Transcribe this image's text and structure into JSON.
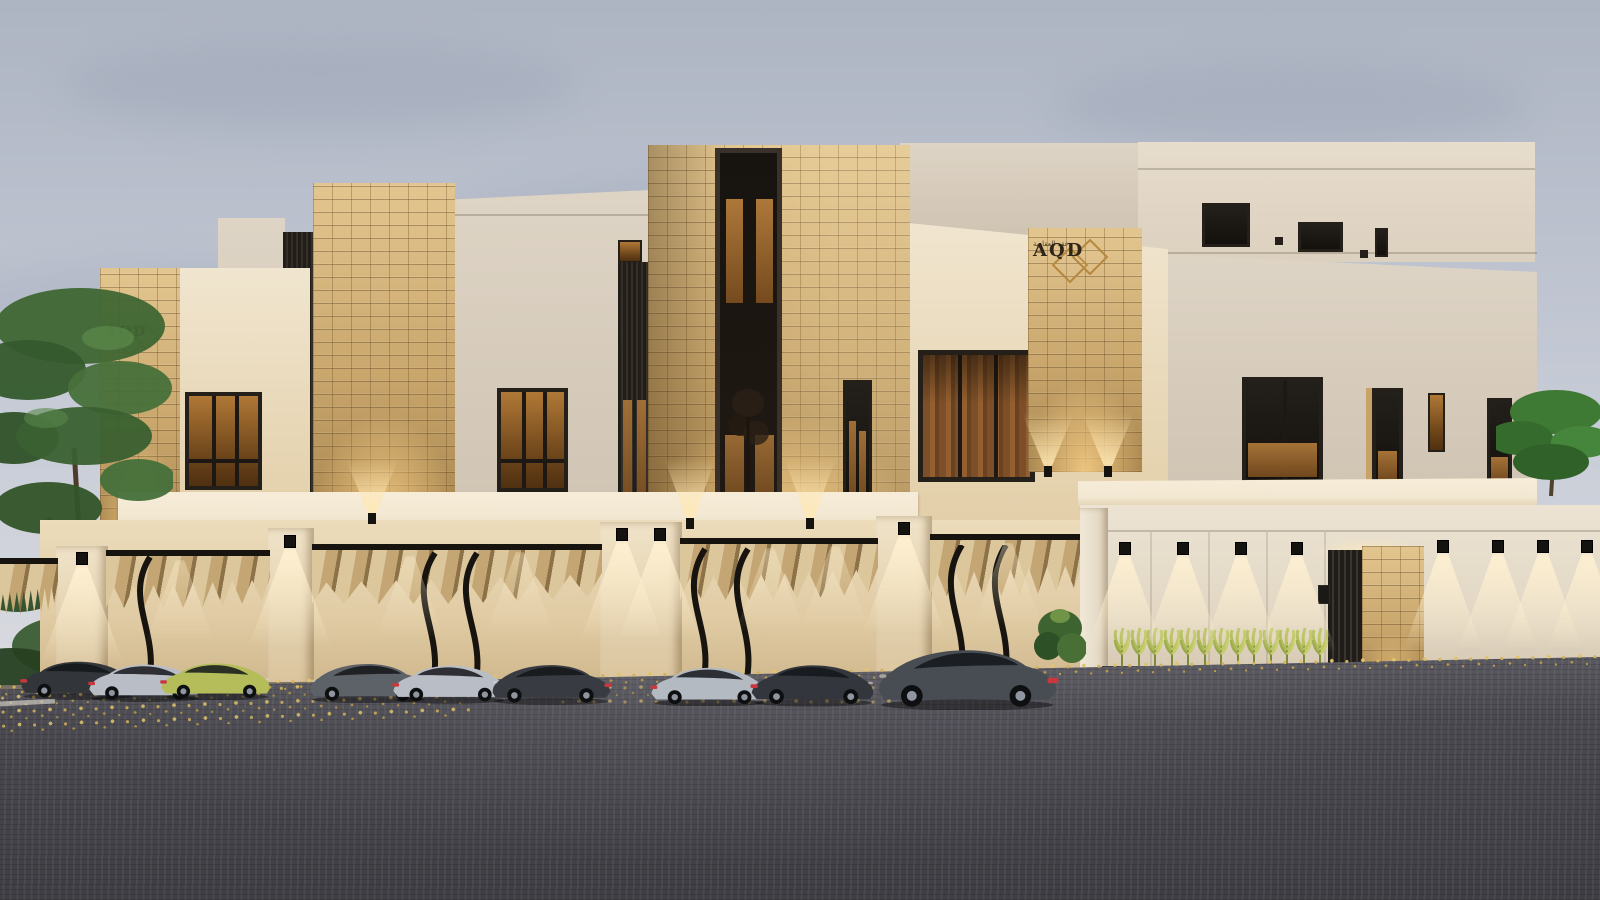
{
  "scene": {
    "type": "architectural-exterior-render",
    "setting": "dusk, overcast sky",
    "description": "Modern beige villa compound with rough stone-clad towers, warm accent lighting, carport with fabric canopies, parked sports cars, asphalt road with scattered leaves"
  },
  "branding": {
    "logo_text": "AQD",
    "logo_subtext": "عقد العقارية",
    "logo_icon": "double-diamond-icon"
  },
  "palette": {
    "sky_top": "#adb4c2",
    "sky_mid": "#c6cbd6",
    "sky_low": "#dcdde2",
    "cloud": "#9aa2b4",
    "facade_warm": "#f0e5cf",
    "facade_warm_deep": "#e3cfa9",
    "facade_cool": "#ded4c5",
    "facade_shadow": "#cdc1b0",
    "stone_light": "#e3c68f",
    "stone_mid": "#c9a76d",
    "stone_dark": "#a8854e",
    "fascia": "#f2e8d2",
    "canopy_light": "#dcc79d",
    "canopy_mid": "#c3a673",
    "canopy_dark": "#8d7147",
    "asphalt": "#4a4950",
    "asphalt_dark": "#3f3e44",
    "asphalt_light": "#5d5c63",
    "leaf1": "#d2b159",
    "leaf2": "#b89a47",
    "leaf3": "#e0c46b",
    "planter_box": "#2e3033",
    "gold": "#b5873f",
    "logo_dark": "#2f2418"
  },
  "cars": [
    {
      "name": "charcoal-sedan",
      "x": 18,
      "y": 700,
      "w": 120,
      "color": "#32353a",
      "flip": false
    },
    {
      "name": "silver-coupe",
      "x": 86,
      "y": 702,
      "w": 118,
      "color": "#b9bec6",
      "flip": false
    },
    {
      "name": "lime-coupe",
      "x": 158,
      "y": 700,
      "w": 116,
      "color": "#b4bd5a",
      "flip": false
    },
    {
      "name": "gray-coupe",
      "x": 306,
      "y": 703,
      "w": 124,
      "color": "#5d6168",
      "flip": true
    },
    {
      "name": "silver-coupe",
      "x": 390,
      "y": 704,
      "w": 120,
      "color": "#b9bec6",
      "flip": false
    },
    {
      "name": "charcoal-fastback",
      "x": 488,
      "y": 705,
      "w": 126,
      "color": "#383b41",
      "flip": true
    },
    {
      "name": "silver-coupe",
      "x": 648,
      "y": 706,
      "w": 122,
      "color": "#b4bac2",
      "flip": false
    },
    {
      "name": "charcoal-fastback",
      "x": 748,
      "y": 707,
      "w": 130,
      "color": "#33363c",
      "flip": false
    },
    {
      "name": "gunmetal-coupe",
      "x": 872,
      "y": 710,
      "w": 190,
      "color": "#484c53",
      "flip": true
    }
  ],
  "lights": {
    "pier_downlights": [
      {
        "x": 82,
        "y": 552
      },
      {
        "x": 290,
        "y": 535
      },
      {
        "x": 622,
        "y": 528
      },
      {
        "x": 660,
        "y": 528
      },
      {
        "x": 904,
        "y": 522
      }
    ],
    "backwall_washes": [
      {
        "x": 180,
        "y": 560
      },
      {
        "x": 410,
        "y": 556
      },
      {
        "x": 520,
        "y": 552
      },
      {
        "x": 770,
        "y": 548
      },
      {
        "x": 835,
        "y": 546
      },
      {
        "x": 1008,
        "y": 543
      }
    ],
    "wall_row_left": {
      "y": 542,
      "xs": [
        1125,
        1183,
        1241,
        1297
      ]
    },
    "wall_row_right": {
      "y": 540,
      "xs": [
        1443,
        1498,
        1543,
        1587
      ]
    },
    "uplights": [
      {
        "x": 372,
        "y": 515,
        "h": 55
      },
      {
        "x": 690,
        "y": 520,
        "h": 62
      },
      {
        "x": 810,
        "y": 520,
        "h": 62
      },
      {
        "x": 1048,
        "y": 468,
        "h": 55
      },
      {
        "x": 1108,
        "y": 468,
        "h": 55
      }
    ]
  },
  "planter": {
    "x_start": 1112,
    "x_end": 1310,
    "y": 624,
    "count": 13
  }
}
